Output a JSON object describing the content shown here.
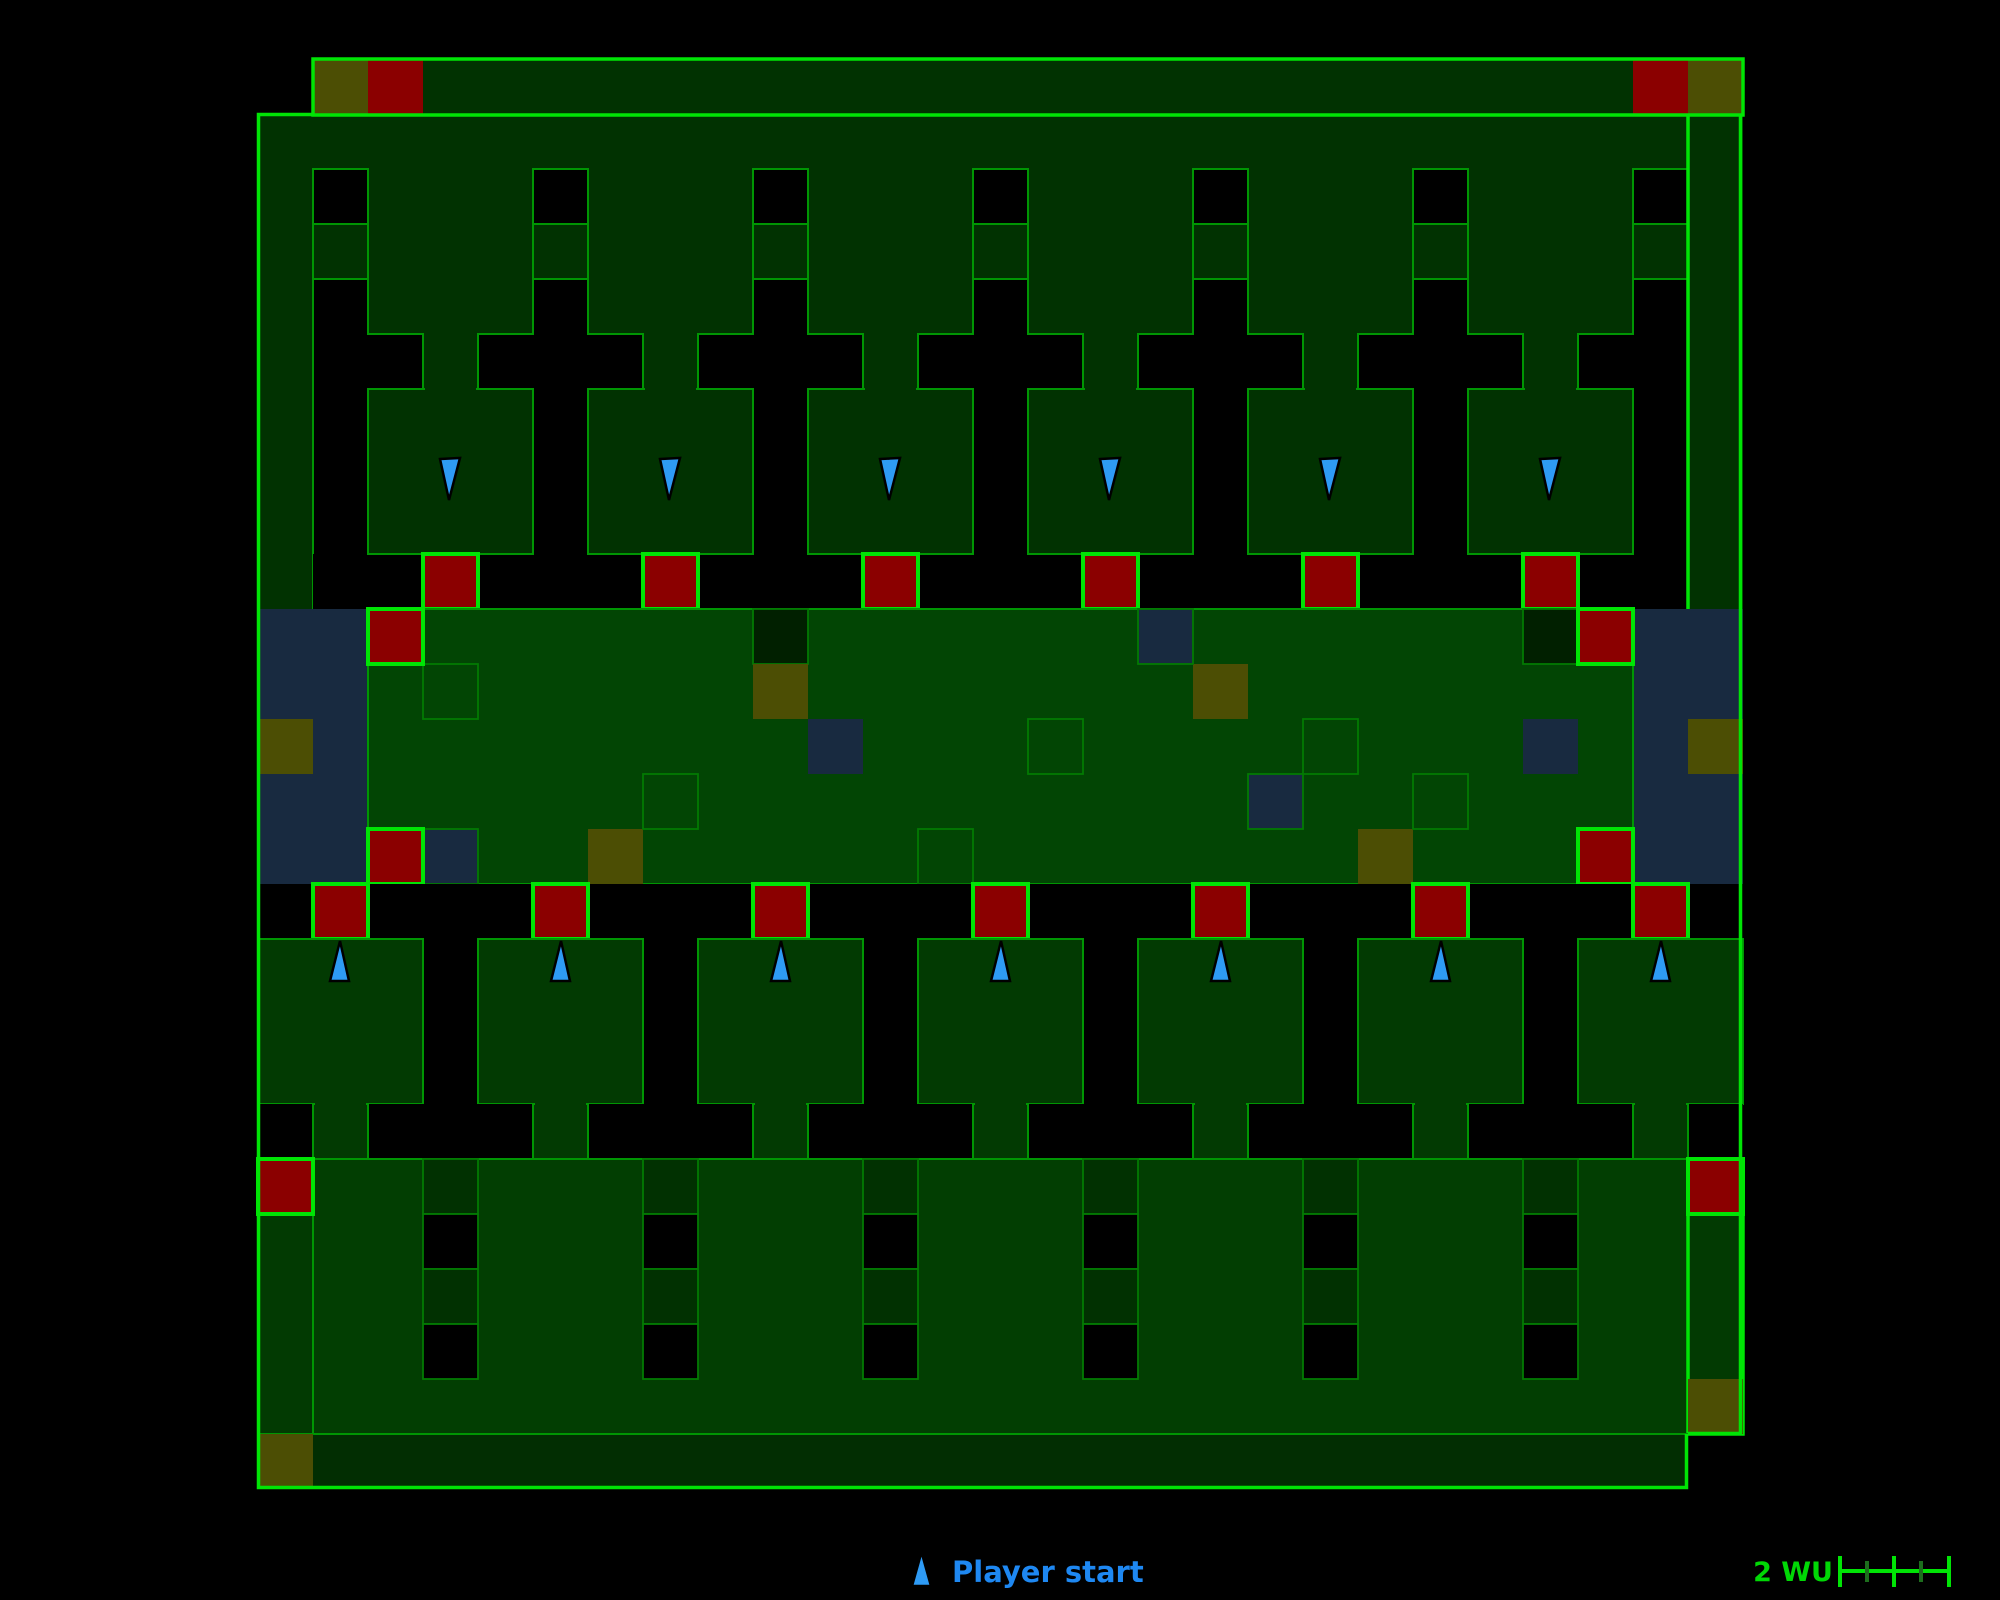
{
  "canvas": {
    "width": 2000,
    "height": 1600,
    "background": "#000000"
  },
  "legend": {
    "items": [
      {
        "icon": "player-start-arrow-icon",
        "label": "Player start",
        "color": "#1e88f2"
      }
    ]
  },
  "scale_bar": {
    "label": "2 WU",
    "color": "#00d805",
    "segments": 4,
    "tick_pattern": "tall-short-tall-short-tall"
  },
  "map": {
    "grid": {
      "cell_px": 55,
      "origin_x": 258,
      "origin_y": 59,
      "cols": 27,
      "rows": 26
    },
    "colors": {
      "outline_bright": "#00e405",
      "outline_wall": "#009603",
      "outline_cell": "#027a02",
      "fill_upper": "#013201",
      "fill_band": "#024504",
      "fill_room": "#023a02",
      "fill_lower": "#023e02",
      "fill_bottom_bar": "#022e02",
      "red_square": "#8b0000",
      "olive_square": "#4c4e04",
      "navy_pool": "#182a40",
      "player_marker": "#2e9bf5"
    },
    "player_starts": {
      "upper_row_facing_down": 6,
      "lower_row_facing_up": 7,
      "total": 13
    },
    "markers": {
      "red_squares": 21,
      "olive_squares": 10,
      "navy_pools": 2,
      "navy_small_squares": 5,
      "outlined_cells_in_band": 6,
      "dark_cells_in_band": 2,
      "window_cells_on_columns": 7,
      "stack_columns": 6
    }
  }
}
